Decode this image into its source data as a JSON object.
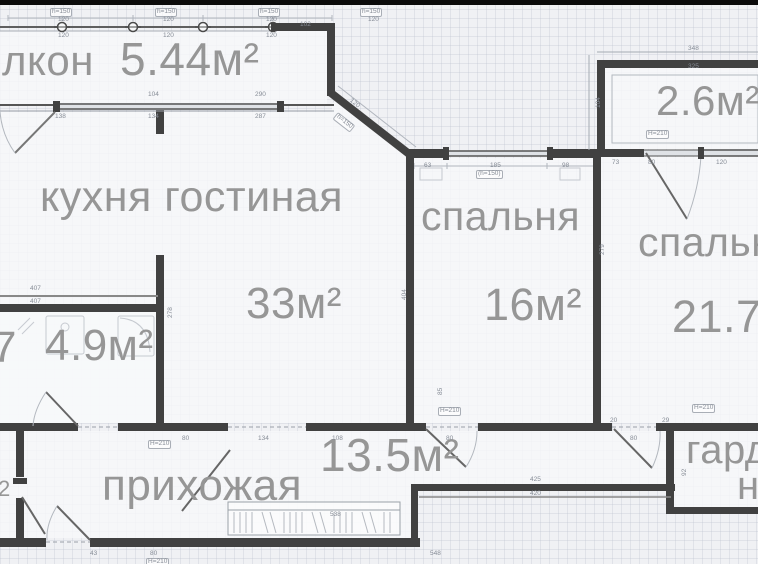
{
  "plan": {
    "rooms": {
      "balcony1": {
        "name_visible": "лкон",
        "area": "5.44м²"
      },
      "kitchen_living": {
        "name": "кухня гостиная",
        "area": "33м²"
      },
      "bathroom": {
        "area": "4.9м²"
      },
      "bedroom1": {
        "name": "спальня",
        "area": "16м²"
      },
      "bedroom2": {
        "name_visible": "спальн",
        "area_visible": "21.7"
      },
      "balcony2": {
        "area": "2.6м²"
      },
      "hallway": {
        "name": "прихожая",
        "area": "13.5м²"
      },
      "wardrobe": {
        "name_visible_line1": "гард",
        "name_visible_line2": "н"
      },
      "partial_left_top": "7",
      "partial_left_bottom": "2"
    },
    "dimension_labels": [
      {
        "t": "h=150",
        "x": 50,
        "y": 8,
        "b": 1
      },
      {
        "t": "120",
        "x": 58,
        "y": 17
      },
      {
        "t": "h=150",
        "x": 155,
        "y": 8,
        "b": 1
      },
      {
        "t": "120",
        "x": 163,
        "y": 17
      },
      {
        "t": "h=150",
        "x": 258,
        "y": 8,
        "b": 1
      },
      {
        "t": "120",
        "x": 266,
        "y": 17
      },
      {
        "t": "h=150",
        "x": 360,
        "y": 8,
        "b": 1
      },
      {
        "t": "120",
        "x": 368,
        "y": 17
      },
      {
        "t": "102",
        "x": 300,
        "y": 22
      },
      {
        "t": "120",
        "x": 58,
        "y": 33
      },
      {
        "t": "120",
        "x": 163,
        "y": 33
      },
      {
        "t": "120",
        "x": 266,
        "y": 33
      },
      {
        "t": "104",
        "x": 148,
        "y": 92
      },
      {
        "t": "290",
        "x": 255,
        "y": 92
      },
      {
        "t": "138",
        "x": 55,
        "y": 114
      },
      {
        "t": "134",
        "x": 148,
        "y": 114
      },
      {
        "t": "287",
        "x": 255,
        "y": 114
      },
      {
        "t": "120",
        "x": 352,
        "y": 98,
        "r40": 1
      },
      {
        "t": "h=150",
        "x": 338,
        "y": 112,
        "b": 1,
        "r40": 1
      },
      {
        "t": "63",
        "x": 424,
        "y": 163
      },
      {
        "t": "185",
        "x": 490,
        "y": 163
      },
      {
        "t": "98",
        "x": 562,
        "y": 163
      },
      {
        "t": "(h=150)",
        "x": 476,
        "y": 170,
        "b": 1
      },
      {
        "t": "348",
        "x": 688,
        "y": 46
      },
      {
        "t": "325",
        "x": 688,
        "y": 64
      },
      {
        "t": "H=210",
        "x": 646,
        "y": 130,
        "b": 1
      },
      {
        "t": "73",
        "x": 612,
        "y": 160
      },
      {
        "t": "80",
        "x": 648,
        "y": 160
      },
      {
        "t": "120",
        "x": 716,
        "y": 160
      },
      {
        "t": "407",
        "x": 30,
        "y": 286
      },
      {
        "t": "407",
        "x": 30,
        "y": 299
      },
      {
        "t": "278",
        "x": 168,
        "y": 318,
        "r": 1
      },
      {
        "t": "404",
        "x": 402,
        "y": 300,
        "r": 1
      },
      {
        "t": "279",
        "x": 600,
        "y": 255,
        "r": 1
      },
      {
        "t": "104",
        "x": 596,
        "y": 108,
        "r": 1
      },
      {
        "t": "H=210",
        "x": 148,
        "y": 440,
        "b": 1
      },
      {
        "t": "80",
        "x": 182,
        "y": 436
      },
      {
        "t": "134",
        "x": 258,
        "y": 436
      },
      {
        "t": "108",
        "x": 332,
        "y": 436
      },
      {
        "t": "H=210",
        "x": 438,
        "y": 407,
        "b": 1
      },
      {
        "t": "80",
        "x": 446,
        "y": 436
      },
      {
        "t": "20",
        "x": 610,
        "y": 418
      },
      {
        "t": "80",
        "x": 630,
        "y": 436
      },
      {
        "t": "29",
        "x": 662,
        "y": 418
      },
      {
        "t": "H=210",
        "x": 692,
        "y": 404,
        "b": 1
      },
      {
        "t": "425",
        "x": 530,
        "y": 477
      },
      {
        "t": "420",
        "x": 530,
        "y": 491
      },
      {
        "t": "548",
        "x": 430,
        "y": 551
      },
      {
        "t": "538",
        "x": 330,
        "y": 512
      },
      {
        "t": "43",
        "x": 90,
        "y": 551
      },
      {
        "t": "80",
        "x": 150,
        "y": 551
      },
      {
        "t": "H=210",
        "x": 146,
        "y": 558,
        "b": 1
      },
      {
        "t": "92",
        "x": 682,
        "y": 476,
        "r": 1
      },
      {
        "t": "85",
        "x": 438,
        "y": 395,
        "r": 1
      }
    ]
  },
  "colors": {
    "wall": "#414141",
    "label_text": "#969696",
    "dim_text": "#868c96",
    "background": "#f0f1f4",
    "top_bar": "#0b0b0b"
  }
}
